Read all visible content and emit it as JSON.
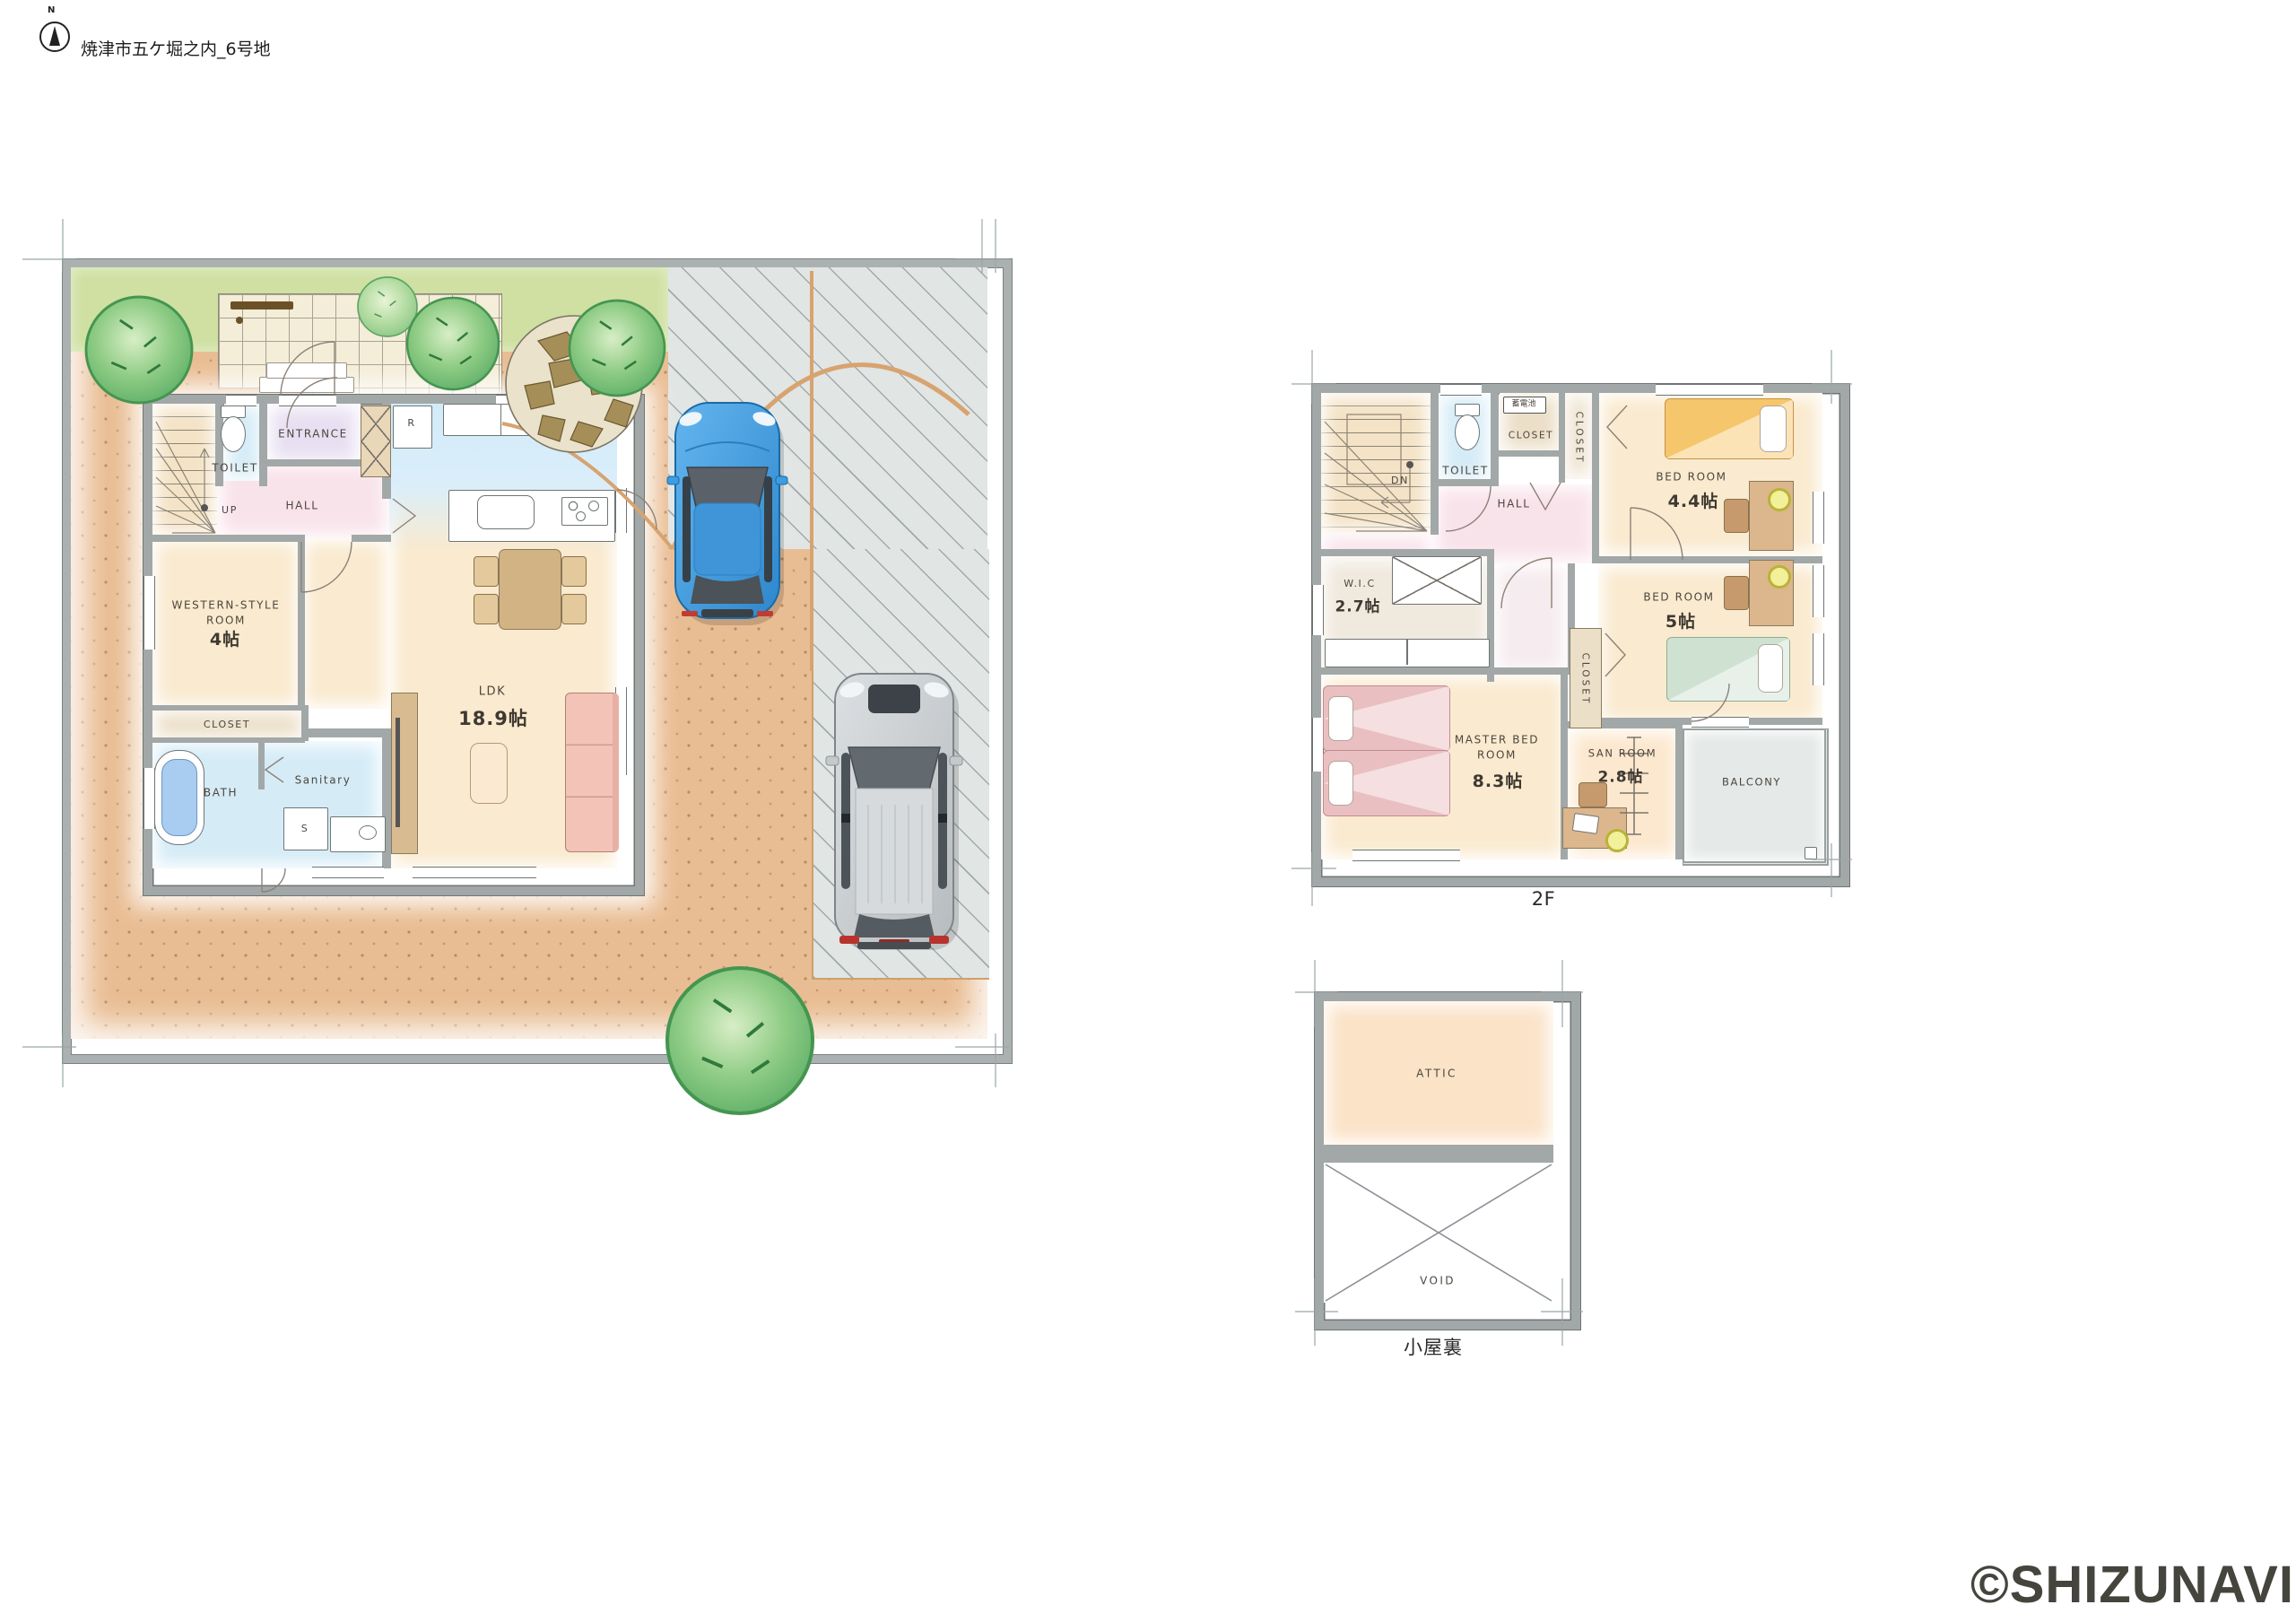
{
  "header": {
    "north_label": "N",
    "title": "焼津市五ケ堀之内_6号地"
  },
  "floor1": {
    "entrance": "ENTRANCE",
    "toilet": "TOILET",
    "hall": "HALL",
    "up": "UP",
    "fridge": "R",
    "western_name": "WESTERN-STYLE ROOM",
    "western_size": "4帖",
    "closet": "CLOSET",
    "bath": "BATH",
    "sanitary": "Sanitary",
    "washer": "S",
    "ldk_name": "LDK",
    "ldk_size": "18.9帖"
  },
  "floor2": {
    "label": "2F",
    "down": "DN",
    "battery": "蓄電池",
    "toilet": "TOILET",
    "closet_top": "CLOSET",
    "closet_right": "CLOSET",
    "closet_mid": "CLOSET",
    "hall": "HALL",
    "bedroom1_name": "BED ROOM",
    "bedroom1_size": "4.4帖",
    "bedroom2_name": "BED ROOM",
    "bedroom2_size": "5帖",
    "wic_name": "W.I.C",
    "wic_size": "2.7帖",
    "master_name": "MASTER BED ROOM",
    "master_size": "8.3帖",
    "sanroom_name": "SAN ROOM",
    "sanroom_size": "2.8帖",
    "balcony": "BALCONY"
  },
  "attic": {
    "label": "小屋裏",
    "attic": "ATTIC",
    "void": "VOID"
  },
  "watermark": "©SHIZUNAVI",
  "palette": {
    "wall": "#a2a8a8",
    "dirt": "#e9bd93",
    "grass": "#cfe0a2",
    "concrete": "#e1e5e4",
    "path_arc": "#d7a36f",
    "floor": "#faeacf",
    "hall_pink": "#f9e3eb",
    "water_blue": "#d5ecf7",
    "entrance_lavender": "#e8e0f2",
    "car_blue": "#3d9de0",
    "car_silver": "#c9cdd0"
  }
}
